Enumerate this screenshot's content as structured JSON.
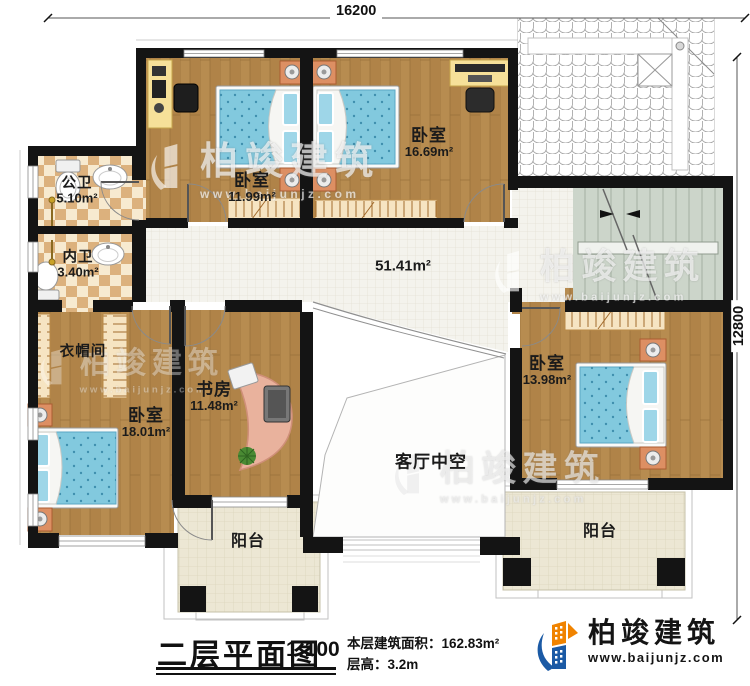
{
  "plan": {
    "dimensions": {
      "top": "16200",
      "right": "12800"
    },
    "rooms": [
      {
        "name": "公卫",
        "area": "5.10m²"
      },
      {
        "name": "内卫",
        "area": "3.40m²"
      },
      {
        "name": "卧室",
        "area": "11.99m²"
      },
      {
        "name": "卧室",
        "area": "16.69m²"
      },
      {
        "name": "",
        "area": "51.41m²"
      },
      {
        "name": "衣帽间",
        "area": ""
      },
      {
        "name": "卧室",
        "area": "18.01m²"
      },
      {
        "name": "书房",
        "area": "11.48m²"
      },
      {
        "name": "卧室",
        "area": "13.98m²"
      },
      {
        "name": "客厅中空",
        "area": ""
      },
      {
        "name": "阳台",
        "area": ""
      },
      {
        "name": "阳台",
        "area": ""
      }
    ]
  },
  "caption": {
    "title": "二层平面图",
    "scale": "1:100",
    "floor_area": "本层建筑面积：162.83m²",
    "floor_height": "层高：3.2m"
  },
  "brand": {
    "name": "柏竣建筑",
    "url": "www.baijunjz.com"
  },
  "watermark": {
    "text": "柏竣建筑",
    "url": "www.baijunjz.com"
  },
  "colors": {
    "wall": "#141414",
    "wood": "#b08348",
    "bed": "#82c9de",
    "brand_blue": "#1b5aa5",
    "brand_orange": "#f08300"
  }
}
